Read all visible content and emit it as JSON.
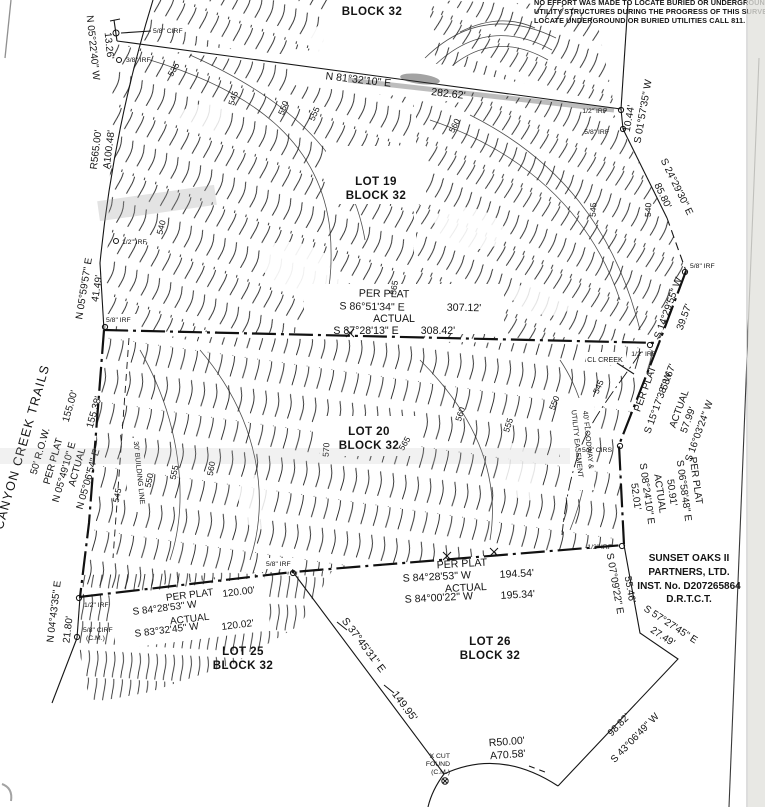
{
  "note": {
    "line1": "NO EFFORT WAS MADE TO LOCATE BURIED OR UNDERGROUND",
    "line2": "UTILITY STRUCTURES DURING THE PROGRESS OF THIS SURVEY. TO",
    "line3": "LOCATE UNDERGROUND OR BURIED UTILITIES CALL 811."
  },
  "titles": {
    "top_block": "BLOCK 32"
  },
  "lots": {
    "lot19": {
      "name": "LOT 19",
      "block": "BLOCK 32"
    },
    "lot20": {
      "name": "LOT 20",
      "block": "BLOCK 32"
    },
    "lot25": {
      "name": "LOT 25",
      "block": "BLOCK 32"
    },
    "lot26": {
      "name": "LOT 26",
      "block": "BLOCK 32"
    }
  },
  "owner": {
    "line1": "SUNSET OAKS II",
    "line2": "PARTNERS, LTD.",
    "line3": "INST. No. D207265864",
    "line4": "D.R.T.C.T."
  },
  "street": {
    "name": "CANYON CREEK TRAILS",
    "row": "50' R.O.W."
  },
  "labels": {
    "per_plat": "PER PLAT",
    "actual": "ACTUAL"
  },
  "bearings": {
    "nw": {
      "bearing": "N 05°22'40\" W",
      "dist": "13.26'"
    },
    "curve_w": {
      "r": "R565.00'",
      "a": "A100.48'"
    },
    "w1": {
      "bearing": "N 05°59'57\" E",
      "dist": "41.49'"
    },
    "w2": {
      "pp_bearing": "N 05°49'10\" E",
      "pp_dist": "155.00'",
      "act_bearing": "N 05°06'54\" E",
      "act_dist": "155.38'"
    },
    "w3": {
      "bearing": "N 04°43'35\" E",
      "dist": "21.80'"
    },
    "n19": {
      "bearing": "N 81°32'10\" E",
      "dist": "282.62'"
    },
    "ne1": {
      "bearing": "S 01°57'35\" W",
      "dist": "10.44'"
    },
    "ne2": {
      "bearing": "S 24°29'30\" E",
      "dist": "85.80'"
    },
    "e1": {
      "bearing": "S 14°29'55\" W",
      "dist": "39.57'"
    },
    "e2": {
      "pp_bearing": "S 15°17'38\" W",
      "pp_dist": "58.67'",
      "act_bearing": "S 16°03'24\" W",
      "act_dist": "57.99'"
    },
    "e3": {
      "pp_bearing": "S 06°58'48\" E",
      "pp_dist": "50.91'",
      "act_bearing": "S 08°24'10\" E",
      "act_dist": "52.01'"
    },
    "se1": {
      "bearing": "S 07°09'22\" E",
      "dist": "55.46'"
    },
    "se2": {
      "bearing": "S 57°27'45\" E",
      "dist": "27.49'"
    },
    "se3": {
      "bearing": "S 43°06'49\" W",
      "dist": "98.82'"
    },
    "curve_s": {
      "r": "R50.00'",
      "a": "A70.58'"
    },
    "diag": {
      "bearing": "S 37°45'31\" E",
      "dist": "149.95'"
    },
    "n20": {
      "pp_bearing": "S 86°51'34\" E",
      "pp_dist": "307.12'",
      "act_bearing": "S 87°28'13\" E",
      "act_dist": "308.42'"
    },
    "s1": {
      "pp_bearing": "S 84°28'53\" W",
      "pp_dist": "194.54'",
      "act_bearing": "S 84°00'22\" W",
      "act_dist": "195.34'"
    },
    "s2": {
      "pp_bearing": "S 84°28'53\" W",
      "pp_dist": "120.00'",
      "act_bearing": "S 83°32'45\" W",
      "act_dist": "120.02'"
    }
  },
  "markers": {
    "cirf58": "5/8\" CIRF",
    "irf38": "3/8\" IRF",
    "irf12": "1/2\" IRF",
    "irf58": "5/8\" IRF",
    "cirs58": "5/8\" CIRS",
    "cirf_cm_1": "5/8\" CIRF",
    "cirf_cm_2": "(C.M.)",
    "xcut1": "X CUT",
    "xcut2": "FOUND",
    "xcut3": "(C.M.)"
  },
  "features": {
    "creek": "CL CREEK",
    "easement1": "40' FLOODWAY &",
    "easement2": "UTILITY EASEMENT",
    "building_line": "30' BUILDING LINE"
  },
  "contours": {
    "c535": "535",
    "c540": "540",
    "c545": "545",
    "c550": "550",
    "c555": "555",
    "c560": "560",
    "c565": "565",
    "c570": "570"
  }
}
